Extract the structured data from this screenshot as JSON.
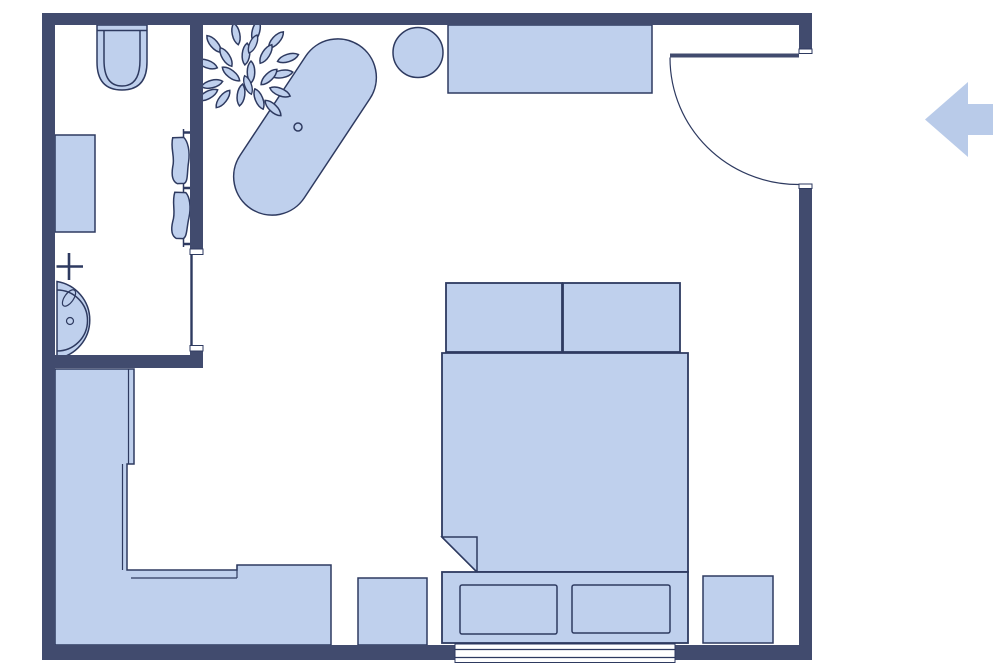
{
  "canvas": {
    "width": 1000,
    "height": 667,
    "background": "#ffffff"
  },
  "colors": {
    "wall": "#414b6e",
    "furniture_fill": "#bfd0ed",
    "outline": "#2e3a60",
    "arrow": "#b9cbe9",
    "bg": "#ffffff"
  },
  "plan": {
    "type": "floor-plan",
    "rooms": [
      {
        "name": "bathroom",
        "items": [
          "toilet",
          "vanity-shelf",
          "towel-radiator",
          "sink-with-faucet",
          "bathroom-door-opening"
        ]
      },
      {
        "name": "bedroom",
        "items": [
          "potted-plant",
          "freestanding-bathtub",
          "round-stool",
          "console-table",
          "entry-door-with-swing",
          "double-bed",
          "pillow-left",
          "pillow-right",
          "blanket-fold",
          "foot-bench-with-drawers",
          "nightstand-left",
          "nightstand-right",
          "l-shaped-wardrobe",
          "window-bottom-wall"
        ]
      }
    ],
    "controls": [
      {
        "name": "exit-left-arrow",
        "direction": "left"
      }
    ]
  }
}
